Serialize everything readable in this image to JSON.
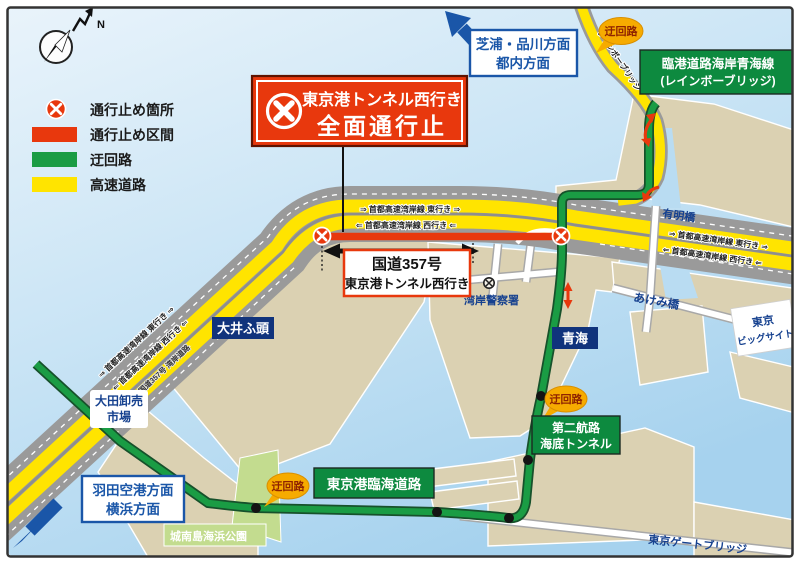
{
  "compass": {
    "n": "N"
  },
  "legend": {
    "items": [
      {
        "label": "通行止め箇所",
        "type": "closure-point",
        "color": "#e8380d"
      },
      {
        "label": "通行止め区間",
        "type": "closure-section",
        "color": "#e8380d"
      },
      {
        "label": "迂回路",
        "type": "detour",
        "color": "#1a9c44"
      },
      {
        "label": "高速道路",
        "type": "expressway",
        "color": "#ffe400"
      }
    ]
  },
  "banner": {
    "line1": "東京港トンネル西行き",
    "line2": "全面通行止"
  },
  "route_box": {
    "line1": "国道357号",
    "line2": "東京港トンネル西行き"
  },
  "directions": {
    "top": {
      "line1": "芝浦・品川方面",
      "line2": "都内方面"
    },
    "bottom_left": {
      "line1": "羽田空港方面",
      "line2": "横浜方面"
    }
  },
  "badges": {
    "label": "迂回路"
  },
  "signs": {
    "rinkai": {
      "line1": "臨港道路海岸青海線",
      "line2": "(レインボーブリッジ)"
    },
    "tokyo_rinkai": "東京港臨海道路",
    "daini": {
      "line1": "第二航路",
      "line2": "海底トンネル"
    }
  },
  "highway_labels": {
    "east": "⇒ 首都高速湾岸線 東行き ⇒",
    "west": "⇐ 首都高速湾岸線 西行き ⇐",
    "route357": "国道357号 湾岸道路"
  },
  "places": {
    "oi_wharf": "大井ふ頭",
    "aomi": "青海",
    "ota_market_line1": "大田卸売",
    "ota_market_line2": "市場",
    "jonanjima": "城南島海浜公園",
    "big_sight_line1": "東京",
    "big_sight_line2": "ビッグサイト",
    "gate_bridge": "東京ゲートブリッジ",
    "ariake_bridge": "有明橋",
    "akemi_bridge": "あけみ橋",
    "police": "湾岸警察署",
    "rainbow_on_road": "レインボーブリッジ"
  },
  "colors": {
    "closure_red": "#e8380d",
    "detour_green": "#1a9c44",
    "expressway_yellow": "#ffe400",
    "water": "#c7e3f5",
    "land": "#dbd1b2",
    "navy": "#16418f",
    "badge_orange": "#f6ab00",
    "sign_green": "#0d8a3f"
  }
}
